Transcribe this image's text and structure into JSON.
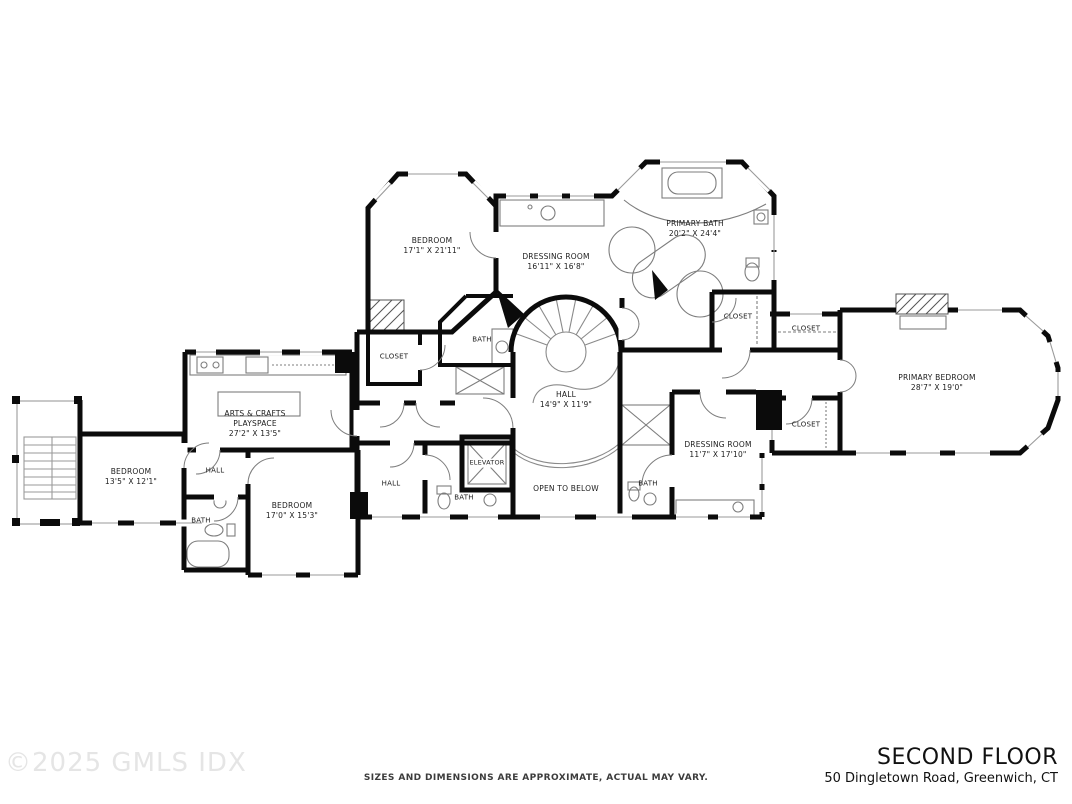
{
  "plan": {
    "type": "residential-floor-plan",
    "rooms": [
      {
        "id": "bedroom-top-left",
        "name": "BEDROOM",
        "dims": "17'1\" X 21'11\""
      },
      {
        "id": "dressing-room-main",
        "name": "DRESSING ROOM",
        "dims": "16'11\" X 16'8\""
      },
      {
        "id": "primary-bath",
        "name": "PRIMARY BATH",
        "dims": "20'2\" X 24'4\""
      },
      {
        "id": "closet-bath",
        "name": "CLOSET"
      },
      {
        "id": "closet-corridor",
        "name": "CLOSET"
      },
      {
        "id": "primary-bedroom",
        "name": "PRIMARY BEDROOM",
        "dims": "28'7\" X 19'0\""
      },
      {
        "id": "closet-lower",
        "name": "CLOSET"
      },
      {
        "id": "dressing-room-2",
        "name": "DRESSING ROOM",
        "dims": "11'7\" X 17'10\""
      },
      {
        "id": "hall-main",
        "name": "HALL",
        "dims": "14'9\" X 11'9\""
      },
      {
        "id": "open-to-below",
        "name": "OPEN TO BELOW"
      },
      {
        "id": "elevator",
        "name": "ELEVATOR"
      },
      {
        "id": "bath-center",
        "name": "BATH"
      },
      {
        "id": "hall-center",
        "name": "HALL"
      },
      {
        "id": "closet-center",
        "name": "CLOSET"
      },
      {
        "id": "bath-upper",
        "name": "BATH"
      },
      {
        "id": "bath-right",
        "name": "BATH"
      },
      {
        "id": "arts-crafts",
        "name": "ARTS & CRAFTS",
        "line2": "PLAYSPACE",
        "dims": "27'2\" X 13'5\""
      },
      {
        "id": "hall-left",
        "name": "HALL"
      },
      {
        "id": "bedroom-left",
        "name": "BEDROOM",
        "dims": "13'5\" X 12'1\""
      },
      {
        "id": "bath-left",
        "name": "BATH"
      },
      {
        "id": "bedroom-bottom",
        "name": "BEDROOM",
        "dims": "17'0\" X 15'3\""
      }
    ]
  },
  "footer": {
    "watermark": "©2025 GMLS IDX",
    "disclaimer": "SIZES AND DIMENSIONS ARE APPROXIMATE, ACTUAL MAY VARY.",
    "title": "SECOND FLOOR",
    "address": "50 Dingletown Road, Greenwich, CT"
  },
  "colors": {
    "wall": "#0b0b0b",
    "detail": "#8a8a8a",
    "watermark": "#e5e5e5",
    "text": "#1c1c1c",
    "background": "#ffffff"
  }
}
